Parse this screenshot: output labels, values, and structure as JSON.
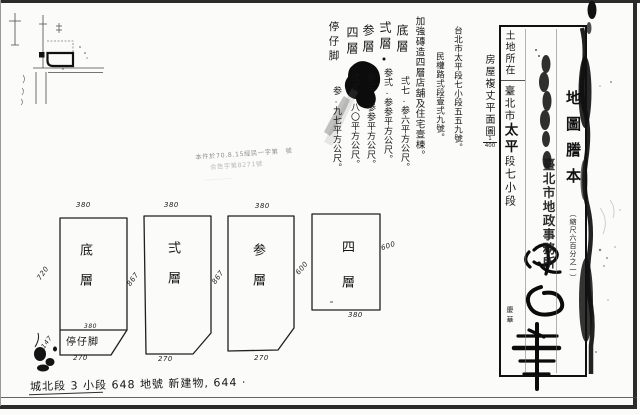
{
  "document": {
    "plan_title": "房屋複丈平面圖",
    "plan_scale_num": "1",
    "plan_scale_den": "400",
    "address_line1": "台北市太平段七小段五五九號。",
    "address_line2": "民權路弍段壹弍九號。",
    "building_description": "加強磚造四層店舖及住宅壹棟。",
    "floor_areas": [
      {
        "label": "底層",
        "area": "弍七.参六平方公尺。"
      },
      {
        "label": "弍層",
        "area": "参弍.参参平方公尺。"
      },
      {
        "label": "参層",
        "area": "参弍.参参平方公尺。"
      },
      {
        "label": "四層",
        "area": "弍弍.八〇平方公尺。"
      },
      {
        "label": "停仔脚",
        "area": "参.九七平方公尺。"
      }
    ]
  },
  "registry_box": {
    "land_location_header": "土地所在",
    "location_print1": "臺北市",
    "location_hand1": "太平",
    "location_print2": "段",
    "location_hand2": "七小段",
    "title": "地圖謄本",
    "scale_note": "（縮尺六百分之一）",
    "office_stamp": "臺北市地政事務所",
    "clerk_initials": "慶華"
  },
  "verification_stamp": {
    "line1": "本件於70.8.15經民一字第　號",
    "line2": "合告字第8271號",
    "line3": "…………"
  },
  "floor_plans": [
    {
      "name": "底層",
      "top": "380",
      "left": "720",
      "right": "867",
      "bottom": "270",
      "porch": {
        "label": "停仔脚",
        "width": "380",
        "height": "147"
      }
    },
    {
      "name": "弍層",
      "top": "380",
      "right": "867",
      "bottom": "270"
    },
    {
      "name": "参層",
      "top": "380",
      "bottom": "270"
    },
    {
      "name": "四層",
      "left": "600",
      "right": "600",
      "bottom": "380"
    }
  ],
  "footer": {
    "line": "城北段 3 小段 648 地號  新建物, 644 ·"
  }
}
